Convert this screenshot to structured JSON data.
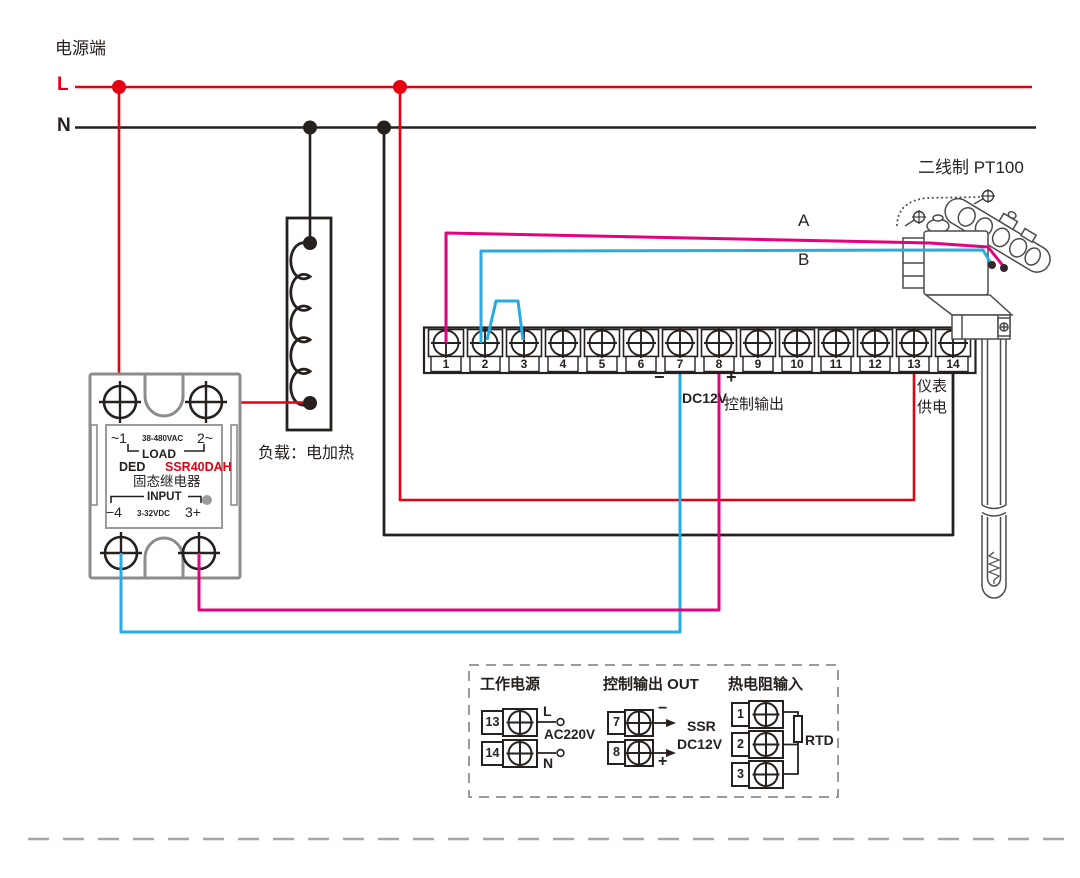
{
  "power": {
    "source_label": "电源端",
    "l": "L",
    "n": "N"
  },
  "load": {
    "label": "负载：电加热"
  },
  "ssr": {
    "line1_left": "~1",
    "line1_mid": "38-480VAC",
    "line1_right": "2~",
    "load_word": "LOAD",
    "ded": "DED",
    "model": "SSR40DAH",
    "name_cn": "固态继电器",
    "input_word": "INPUT",
    "line6_left": "−4",
    "line6_mid": "3-32VDC",
    "line6_right": "3+"
  },
  "terminal_strip": {
    "terminals": [
      "1",
      "2",
      "3",
      "4",
      "5",
      "6",
      "7",
      "8",
      "9",
      "10",
      "11",
      "12",
      "13",
      "14"
    ]
  },
  "wires": {
    "a": "A",
    "b": "B",
    "minus": "−",
    "plus": "+",
    "dc12v": "DC12V",
    "control_output": "控制输出",
    "meter_supply_line1": "仪表",
    "meter_supply_line2": "供电"
  },
  "sensor": {
    "label": "二线制 PT100"
  },
  "legend": {
    "work_power": {
      "title": "工作电源",
      "t13": "13",
      "t14": "14",
      "l": "L",
      "n": "N",
      "voltage": "AC220V"
    },
    "control_output": {
      "title": "控制输出 OUT",
      "t7": "7",
      "t8": "8",
      "minus": "−",
      "plus": "+",
      "ssr": "SSR",
      "dc12v": "DC12V"
    },
    "rtd_input": {
      "title": "热电阻输入",
      "t1": "1",
      "t2": "2",
      "t3": "3",
      "rtd": "RTD"
    }
  },
  "colors": {
    "line_red": "#e60012",
    "wire_magenta": "#e6007e",
    "wire_blue": "#29abe2",
    "line_black": "#26211f",
    "ssr_gray": "#8c8c8c"
  }
}
